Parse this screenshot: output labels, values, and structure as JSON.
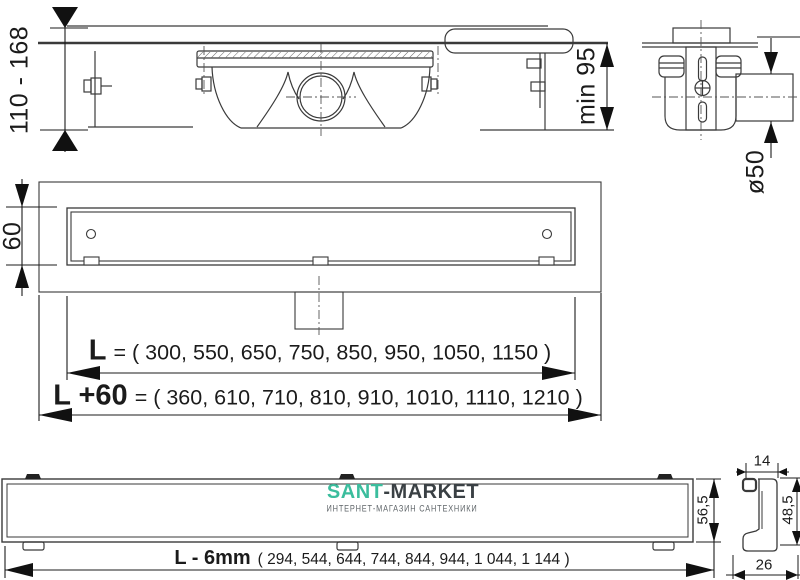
{
  "page": {
    "background_color": "#ffffff",
    "line_color": "#3a3a3a"
  },
  "watermark": {
    "brand_primary": "SANT",
    "brand_secondary": "-MARKET",
    "tagline": "ИНТЕРНЕТ-МАГАЗИН САНТЕХНИКИ",
    "brand_primary_color": "#3bbd9d",
    "brand_secondary_color": "#3a4044",
    "tagline_color": "#5f6569"
  },
  "dimensions": {
    "installation_height_range": "110 - 168",
    "min_installation_depth": "min 95",
    "outlet_pipe_diameter": "ø50",
    "channel_width": "60",
    "body_height": "56,5",
    "profile_top_width": "14",
    "profile_height": "48,5",
    "profile_base_width": "26",
    "length": {
      "label": "L",
      "values": "= ( 300, 550, 650, 750, 850, 950, 1050, 1150 )"
    },
    "length_with_flange": {
      "label": "L +60",
      "values": "= ( 360, 610, 710, 810, 910, 1010, 1110, 1210 )"
    },
    "grate_length": {
      "label": "L - 6mm",
      "values": "( 294, 544, 644, 744, 844, 944, 1 044, 1 144 )"
    }
  }
}
